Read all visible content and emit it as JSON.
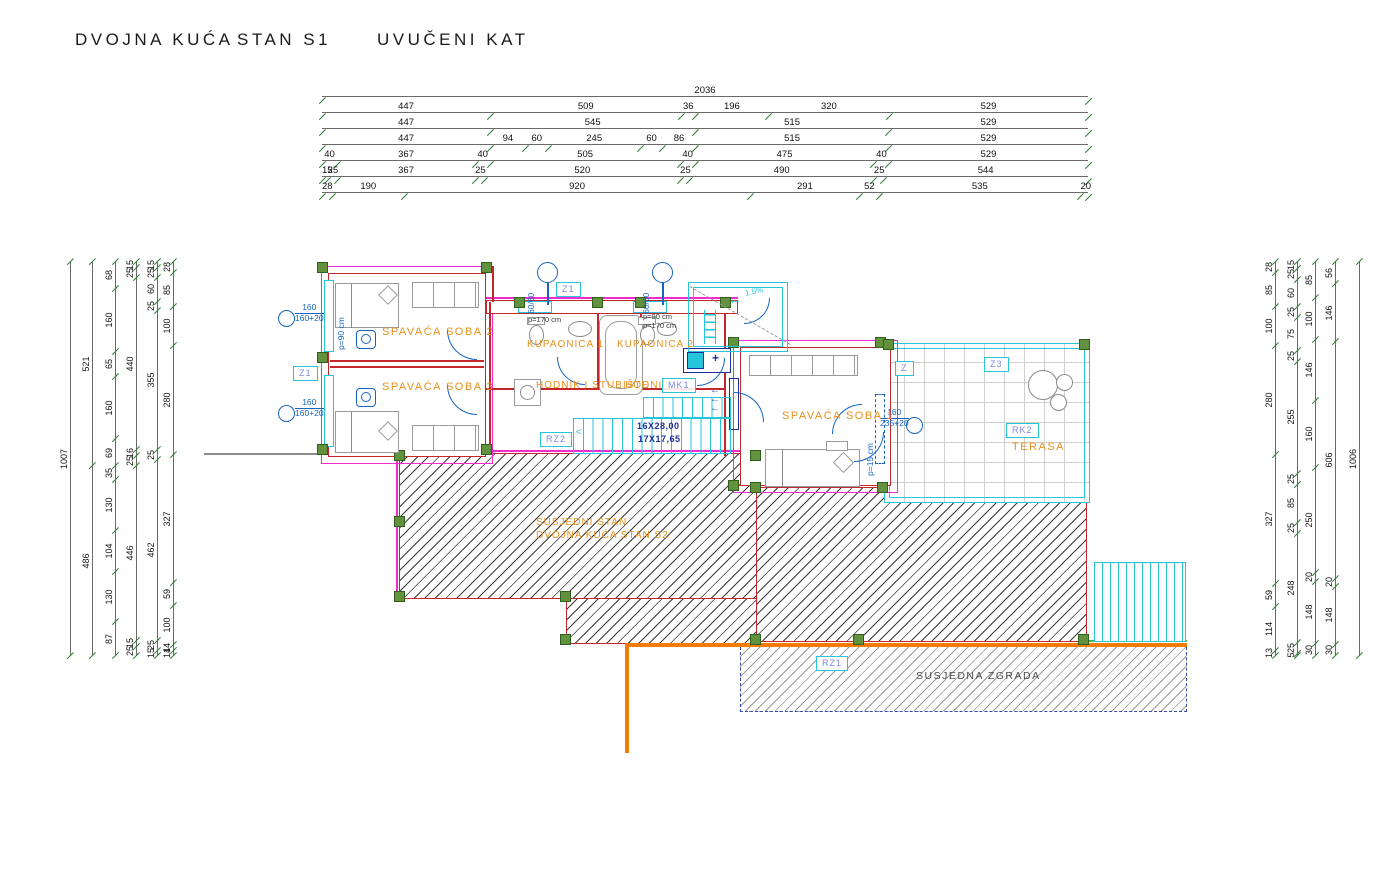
{
  "title": {
    "part1": "DVOJNA KUĆA",
    "part2": "STAN S1",
    "part3": "UVUČENI KAT"
  },
  "top_dims": {
    "total": 2036,
    "rows": [
      [
        2036
      ],
      [
        447,
        509,
        36,
        196,
        320,
        529
      ],
      [
        447,
        545,
        515,
        529
      ],
      [
        447,
        94,
        60,
        245,
        60,
        86,
        515,
        529
      ],
      [
        40,
        367,
        40,
        505,
        40,
        475,
        40,
        529
      ],
      [
        15,
        25,
        367,
        25,
        520,
        25,
        490,
        25,
        544
      ],
      [
        28,
        190,
        920,
        291,
        52,
        535,
        20
      ]
    ]
  },
  "left_dims": {
    "total": 1007,
    "chains": [
      [
        1007
      ],
      [
        521,
        486
      ],
      [
        68,
        160,
        65,
        160,
        69,
        35,
        130,
        104,
        130,
        87
      ],
      [
        15,
        25,
        440,
        16,
        25,
        446,
        15,
        25
      ],
      [
        15,
        25,
        60,
        25,
        355,
        25,
        462,
        25,
        15
      ],
      [
        28,
        85,
        100,
        280,
        327,
        59,
        100,
        14,
        14
      ]
    ]
  },
  "right_dims": {
    "total": 1006,
    "chains": [
      [
        28,
        85,
        100,
        280,
        327,
        59,
        114,
        13
      ],
      [
        15,
        25,
        60,
        25,
        75,
        25,
        255,
        25,
        85,
        25,
        248,
        25,
        5
      ],
      [
        85,
        100,
        146,
        160,
        250,
        20,
        148,
        30
      ],
      [
        56,
        146,
        606,
        20,
        148,
        30
      ],
      [
        1006
      ]
    ]
  },
  "plan": {
    "rooms": {
      "soba2": "SPAVAĆA SOBA 2",
      "soba3": "SPAVAĆA SOBA 3",
      "soba1": "SPAVAĆA SOBA 1",
      "kupaonica1": "KUPAONICA 1",
      "kupaonica2": "KUPAONICA 2",
      "hodnik_stubiste": "HODNIK I STUBIŠTE",
      "hodnik": "HODNIK",
      "terasa": "TERASA",
      "susjedni_stan_line1": "SUSJEDNI STAN",
      "susjedni_stan_line2": "DVOJNA KUĆA STAN S2",
      "susjedna_zgrada": "SUSJEDNA ZGRADA"
    },
    "tags": {
      "z1_top": "Z1",
      "z1_left": "Z1",
      "z": "Z",
      "z3": "Z3",
      "rk2": "RK2",
      "rz2": "RZ2",
      "rz1": "RZ1",
      "mk1": "MK1"
    },
    "annotations": {
      "stairs_line1": "16X28,00",
      "stairs_line2": "17X17,65",
      "slope": "1.5%",
      "parapet_90": "p=90 cm",
      "parapet_170": "p=170 cm",
      "parapet_15": "p=15 cm",
      "vent_size": "60/60",
      "window_left": {
        "num": "160",
        "den": "160+20"
      },
      "window_right": {
        "num": "160",
        "den": "235+20"
      }
    }
  },
  "colors": {
    "wall_red": "#c4272b",
    "insulation_magenta": "#f32ad2",
    "column_green": "#63923f",
    "cyan": "#26c6da",
    "label_orange": "#e8901a",
    "annotation_blue": "#1565c0",
    "boundary_orange": "#f57c00",
    "stair_text_navy": "#1a2e9e",
    "tick_green": "#2e7d32"
  }
}
